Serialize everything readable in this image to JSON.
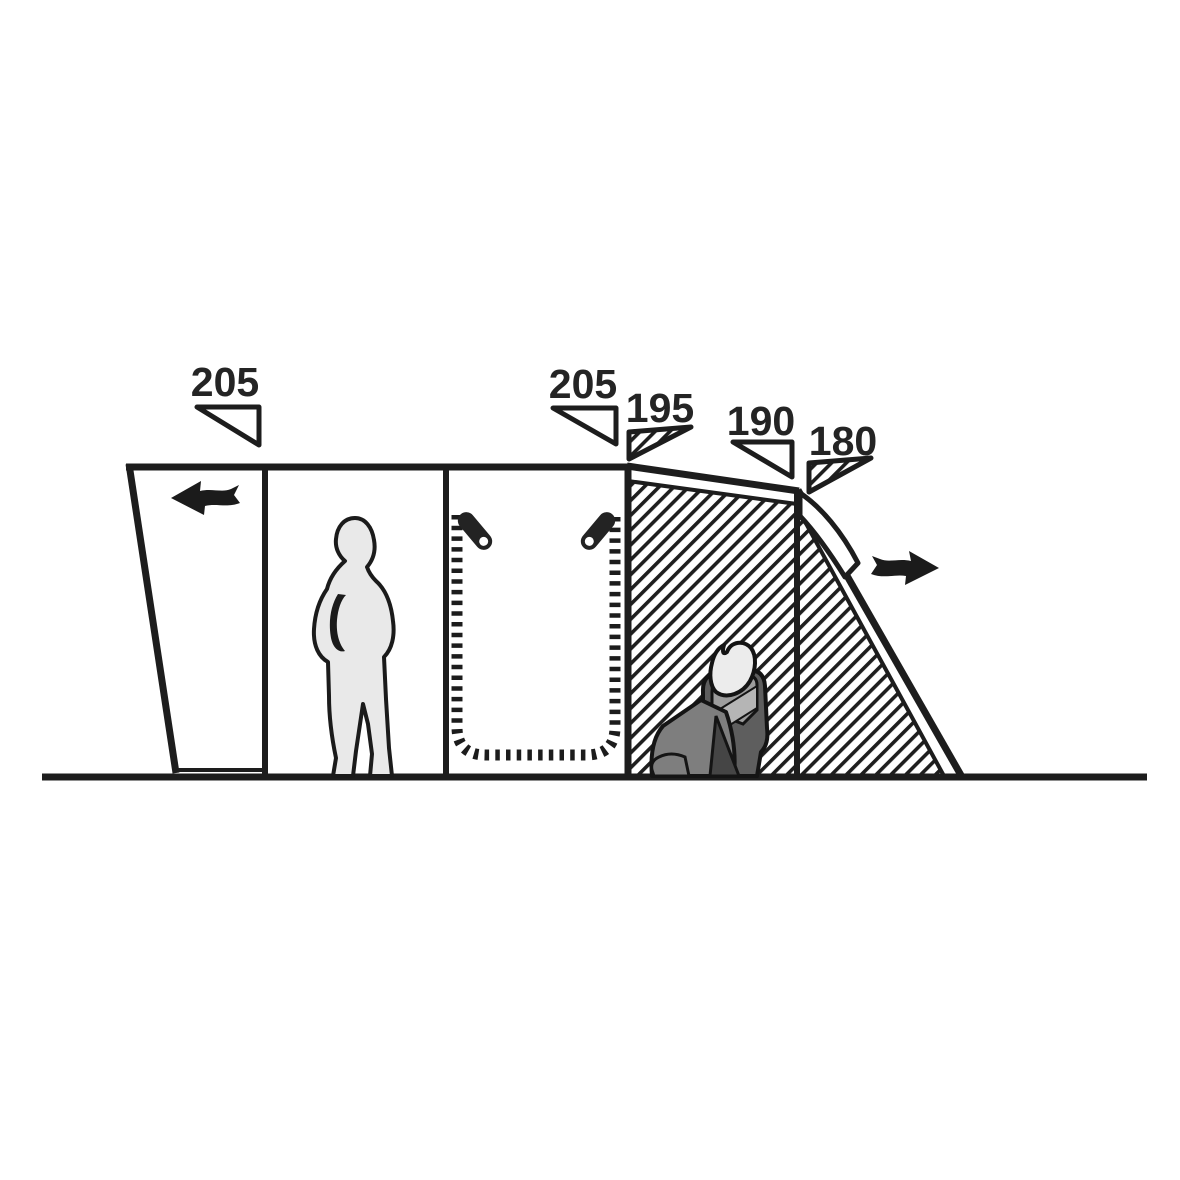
{
  "diagram": {
    "description": "Tent side-profile dimension diagram",
    "measurements": [
      {
        "value": "205",
        "marker": "outline-triangle"
      },
      {
        "value": "205",
        "marker": "outline-triangle"
      },
      {
        "value": "195",
        "marker": "hatched-triangle"
      },
      {
        "value": "190",
        "marker": "outline-triangle"
      },
      {
        "value": "180",
        "marker": "hatched-triangle"
      }
    ],
    "icons": [
      "airflow-arrow-left",
      "airflow-arrow-right",
      "zipper-pull-left",
      "zipper-pull-right",
      "person-standing",
      "person-sitting"
    ],
    "colors": {
      "line": "#1d1d1d",
      "background": "#ffffff",
      "silhouette_light": "#e9e9e9",
      "silhouette_mid": "#8f8f8f",
      "silhouette_dark": "#4f4f4f"
    }
  }
}
